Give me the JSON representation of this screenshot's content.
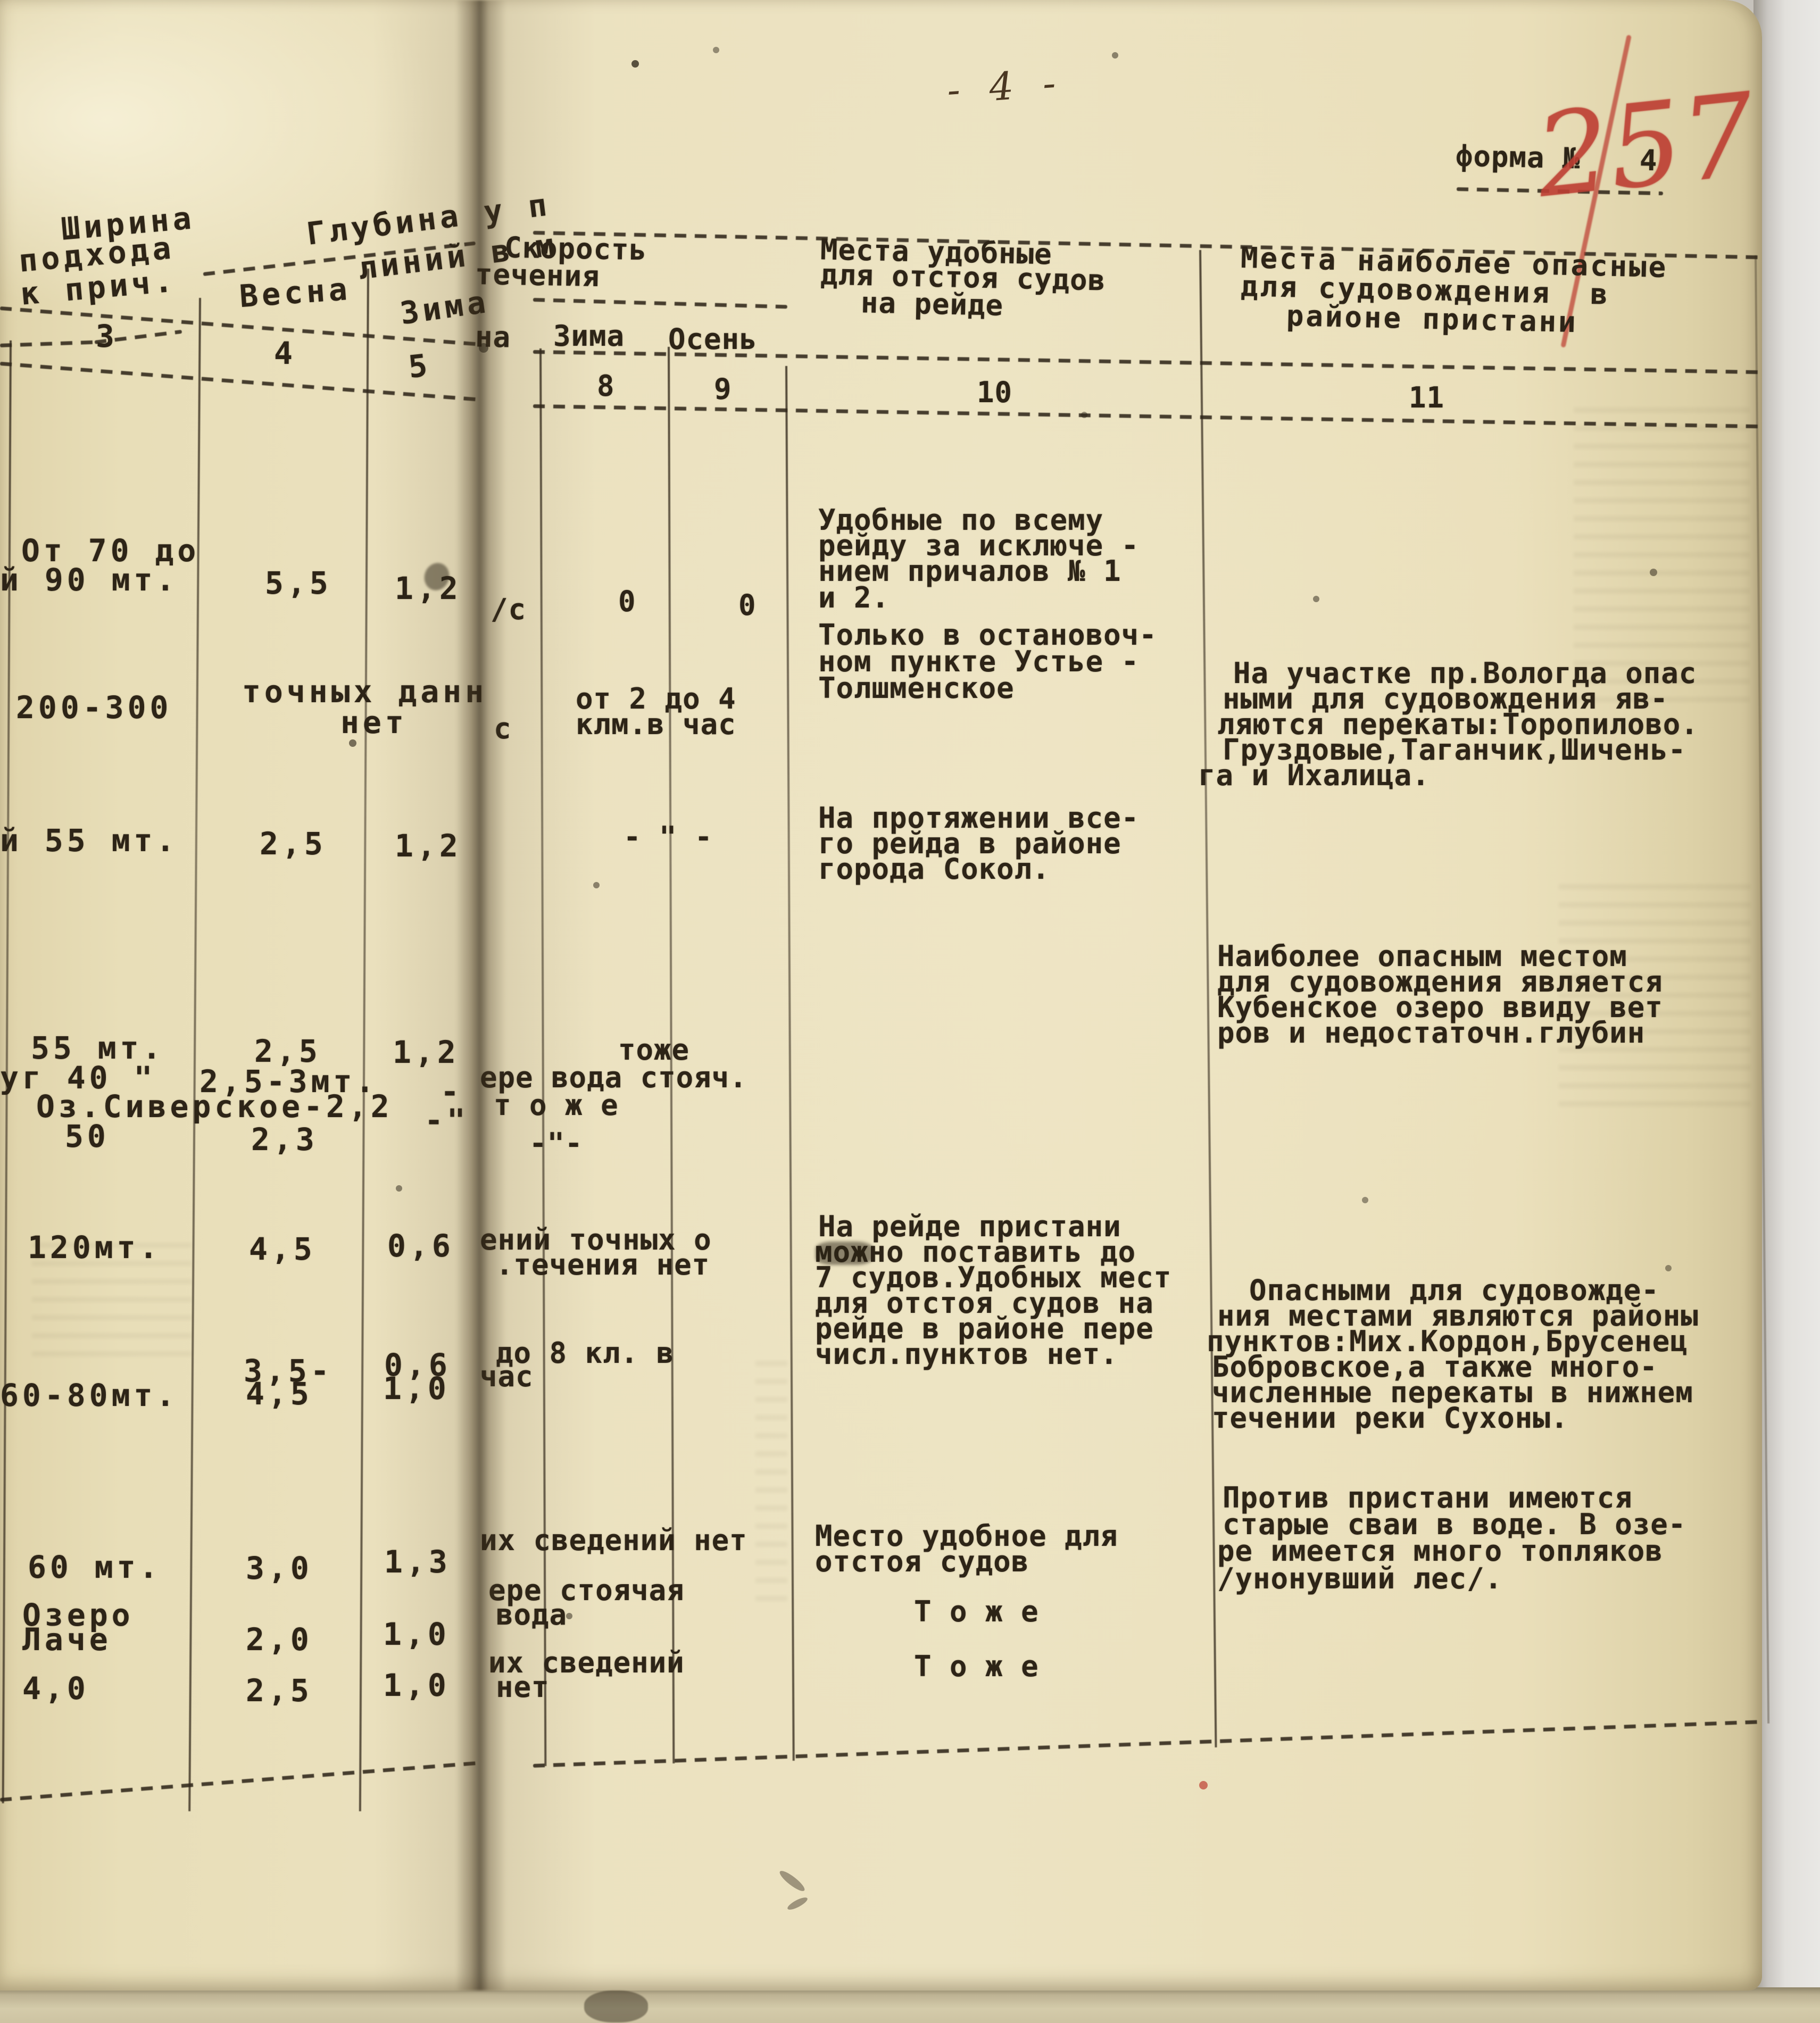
{
  "page": {
    "number": "- 4 -",
    "form_label": "форма №",
    "form_number": "4",
    "red_mark": "257"
  },
  "h": {
    "c3l1": "Ширина",
    "c3l2": "подхода",
    "c3l3": "к прич.",
    "n3": "3",
    "c45l1": "Глубина у п",
    "c45l2": "линий в м",
    "c4sub": "Весна",
    "n4": "4",
    "c5sub": "Зима",
    "n5": "5",
    "c789l1": "Скорость",
    "c789l2": "течения",
    "c7sub": "на",
    "c8sub": "Зима",
    "n8": "8",
    "c9sub": "Осень",
    "n9": "9",
    "c10l1": "Места удобные",
    "c10l2": "для отстоя судов",
    "c10l3": "на рейде",
    "n10": "10",
    "c11l1": "Места наиболее опасные",
    "c11l2": "для судовождения  в",
    "c11l3": "районе пристани",
    "n11": "11"
  },
  "r1": {
    "c3a": "От 70 до",
    "c3b": "й 90 мт.",
    "c4": "5,5",
    "c5": "1,2",
    "f": "/с",
    "c8": "0",
    "c9": "0",
    "c10": [
      "Удобные по всему",
      "рейду за исключе -",
      "нием причалов № 1",
      "и 2."
    ]
  },
  "r2": {
    "c3": "200-300",
    "c45a": "точных данн",
    "c45b": "нет",
    "f": "с",
    "c89a": "от 2 до 4",
    "c89b": "клм.в час",
    "c10": [
      "Только в остановоч-",
      "ном пункте Устье -",
      "Толшменское"
    ],
    "c11": [
      "На участке пр.Вологда опас",
      "ными для судовождения яв-",
      "ляются перекаты:Торопилово.",
      "Груздовые,Таганчик,Шичень-",
      "га и Ихалица."
    ]
  },
  "r3": {
    "c3": "й 55 мт.",
    "c4": "2,5",
    "c5": "1,2",
    "c89": "- \" -",
    "c10": [
      "На протяжении все-",
      "го рейда в районе",
      "города Сокол."
    ]
  },
  "r4": {
    "a3": "55 мт.",
    "a4": "2,5",
    "a5": "1,2",
    "a89": "тоже",
    "b3": "уг 40 \"",
    "b4": "2,5-3мт.",
    "b5": "-",
    "b89": "ере вода стояч.",
    "c34": "Оз.Сиверское-2,2",
    "c5m": "-\"",
    "c89": "т о ж е",
    "d3": "50",
    "d4": "2,3",
    "d5": "-\"-",
    "c11": [
      "Наиболее опасным местом",
      "для судовождения является",
      "Кубенское озеро ввиду вет",
      "ров и недостаточн.глубин"
    ]
  },
  "r5": {
    "c3": "120мт.",
    "c4": "4,5",
    "c5": "0,6",
    "c89a": "ений точных о",
    "c89b": ".течения нет",
    "c10": [
      "На рейде пристани",
      "можно поставить до",
      "7 судов.Удобных мест",
      "для отстоя судов на",
      "рейде в районе пере",
      "числ.пунктов нет."
    ],
    "c11": [
      "Опасными для судовожде-",
      "ния местами являются районы",
      "пунктов:Мих.Кордон,Брусенец",
      "Бобровское,а также много-",
      "численные перекаты в нижнем",
      "течении реки Сухоны."
    ]
  },
  "r6": {
    "c3": "60-80мт.",
    "c4a": "3,5-",
    "c4b": "4,5",
    "c5a": "0,6",
    "c5b": "1,0",
    "c89a": "до 8 кл. в",
    "c89b": "час"
  },
  "r7": {
    "c3": "60 мт.",
    "c4": "3,0",
    "c5": "1,3",
    "c89": "их сведений нет",
    "c10a": "Место удобное для",
    "c10b": "отстоя судов",
    "c11": [
      "Против пристани имеются",
      "старые сваи в воде. В озе-",
      "ре имеется много топляков",
      "/унонувший лес/."
    ]
  },
  "r8": {
    "c3a": "Озеро",
    "c3b": "Лаче",
    "c4": "2,0",
    "c5": "1,0",
    "c89a": "ере стоячая",
    "c89b": "вода",
    "c10": "Т о ж е"
  },
  "r9": {
    "c3": "4,0",
    "c4": "2,5",
    "c5": "1,0",
    "c89a": "их сведений",
    "c89b": "нет",
    "c10": "Т о ж е"
  }
}
